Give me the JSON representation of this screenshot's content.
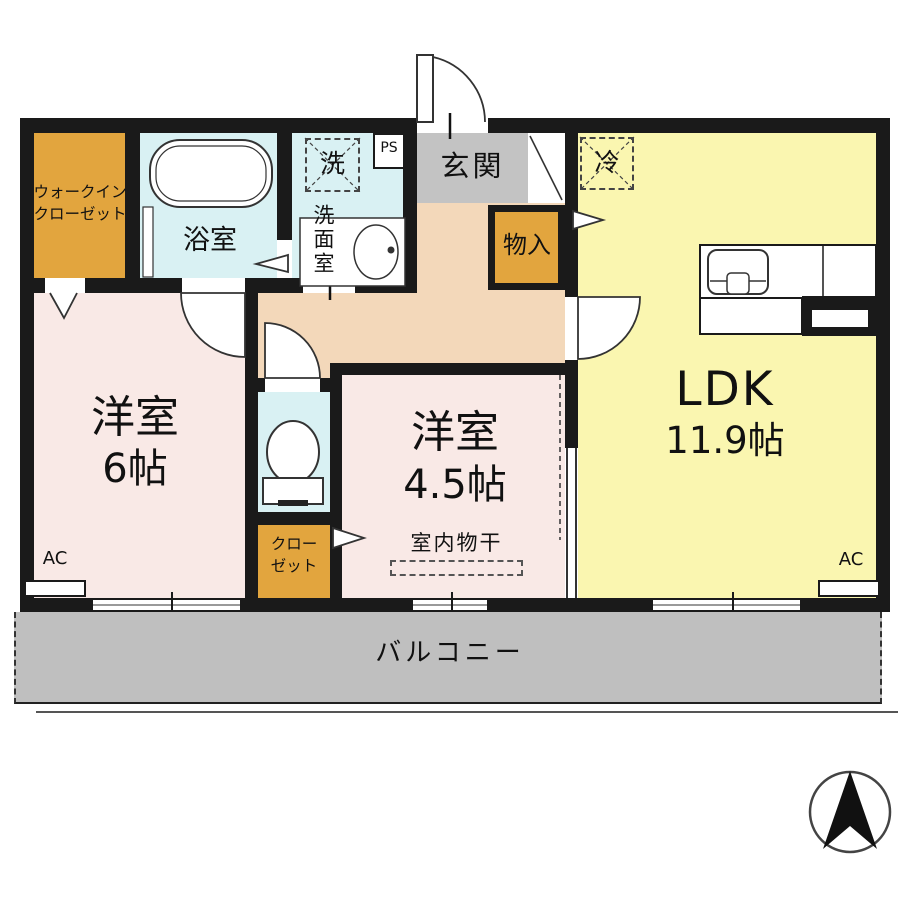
{
  "floorplan": {
    "labels": {
      "wic_line1": "ウォークイン",
      "wic_line2": "クローゼット",
      "bath": "浴室",
      "laundry": "洗",
      "ps": "PS",
      "washroom": "洗面室",
      "genkan": "玄関",
      "storage": "物入",
      "fridge": "冷",
      "ldk": "LDK",
      "ldk_size": "11.9帖",
      "room6": "洋室",
      "room6_size": "6帖",
      "room45": "洋室",
      "room45_size": "4.5帖",
      "closet_line1": "クロー",
      "closet_line2": "ゼット",
      "drying": "室内物干",
      "balcony": "バルコニー",
      "ac_left": "AC",
      "ac_right": "AC"
    },
    "colors": {
      "wall": "#1a1a1a",
      "room_pink": "#f9e9e6",
      "ldk_yellow": "#faf6b0",
      "wet_cyan": "#d9f1f3",
      "closet_orange": "#e2a53e",
      "hall_peach": "#f3d8ba",
      "genkan_gray": "#c3c3c3",
      "balcony_gray": "#bfbfbf"
    }
  }
}
